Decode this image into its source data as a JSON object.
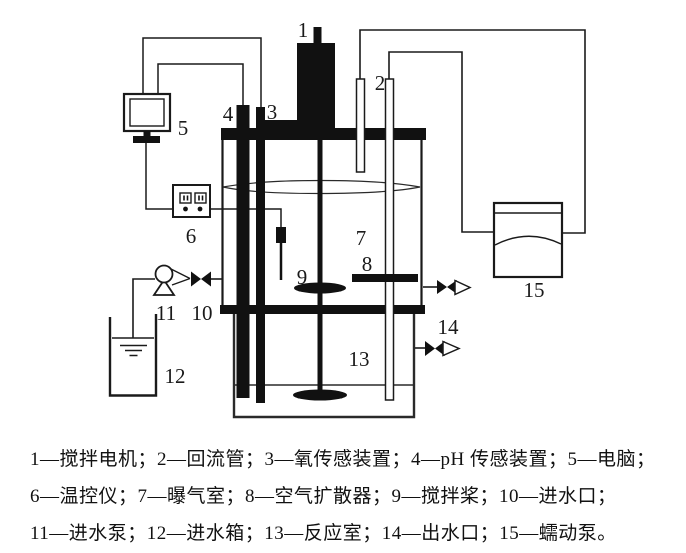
{
  "figure_type": "bioreactor experimental apparatus schematic",
  "colors": {
    "ink": "#1a1a1a",
    "background": "#ffffff"
  },
  "caption": {
    "line1": "1—搅拌电机；2—回流管；3—氧传感装置；4—pH 传感装置；5—电脑；",
    "line2": "6—温控仪；7—曝气室；8—空气扩散器；9—搅拌桨；10—进水口；",
    "line3": "11—进水泵；12—进水箱；13—反应室；14—出水口；15—蠕动泵。"
  },
  "legend": [
    {
      "num": "1",
      "name": "搅拌电机"
    },
    {
      "num": "2",
      "name": "回流管"
    },
    {
      "num": "3",
      "name": "氧传感装置"
    },
    {
      "num": "4",
      "name": "pH 传感装置"
    },
    {
      "num": "5",
      "name": "电脑"
    },
    {
      "num": "6",
      "name": "温控仪"
    },
    {
      "num": "7",
      "name": "曝气室"
    },
    {
      "num": "8",
      "name": "空气扩散器"
    },
    {
      "num": "9",
      "name": "搅拌桨"
    },
    {
      "num": "10",
      "name": "进水口"
    },
    {
      "num": "11",
      "name": "进水泵"
    },
    {
      "num": "12",
      "name": "进水箱"
    },
    {
      "num": "13",
      "name": "反应室"
    },
    {
      "num": "14",
      "name": "出水口"
    },
    {
      "num": "15",
      "name": "蠕动泵"
    }
  ],
  "diagram": {
    "labels": {
      "1": "1",
      "2": "2",
      "3": "3",
      "4": "4",
      "5": "5",
      "6": "6",
      "7": "7",
      "8": "8",
      "9": "9",
      "10": "10",
      "11": "11",
      "12": "12",
      "13": "13",
      "14": "14",
      "15": "15"
    }
  }
}
